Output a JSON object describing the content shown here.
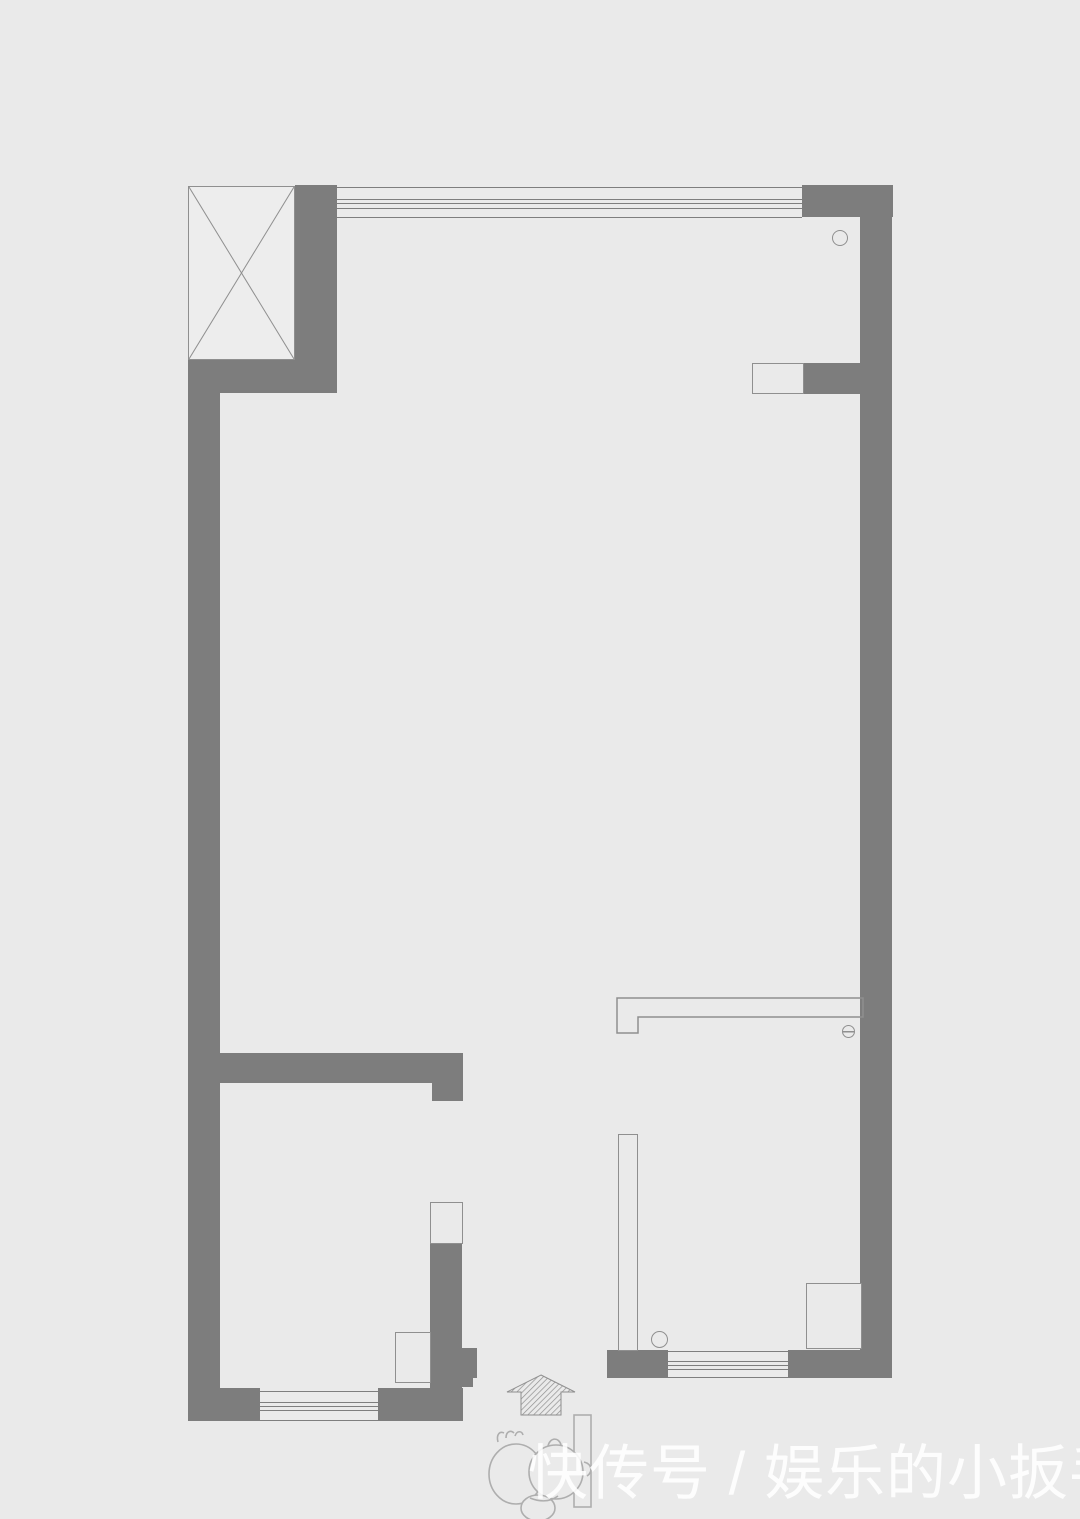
{
  "watermark": {
    "text": "快传号 / 娱乐的小扳手"
  },
  "colors": {
    "background": "#eaeaea",
    "wall": "#7d7d7d",
    "thin_line": "#8f8f8f",
    "window_line": "#7e7e7e",
    "doodle_line": "#aeaeae",
    "watermark_text": "rgba(255,255,255,0.88)"
  }
}
